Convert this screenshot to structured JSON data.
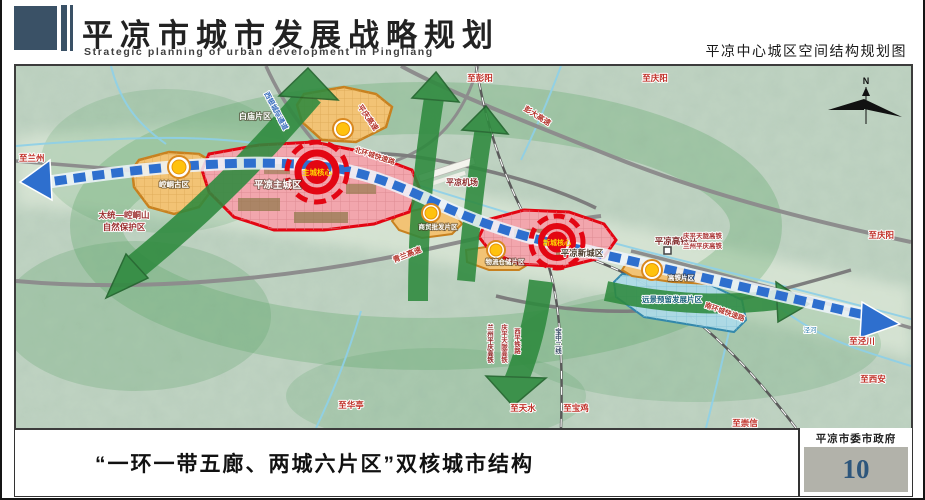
{
  "header": {
    "title": "平凉市城市发展战略规划",
    "subtitle": "Strategic planning of urban development in Pingliang",
    "map_caption": "平凉中心城区空间结构规划图"
  },
  "footer": {
    "caption": "“一环一带五廊、两城六片区”双核城市结构",
    "agency": "平凉市委市政府",
    "page_number": "10"
  },
  "map": {
    "compass": "N",
    "cores": {
      "main": "主城核心",
      "secondary": "新城核心"
    },
    "zones": {
      "main_city": "平凉主城区",
      "new_city": "平凉新城区",
      "kongtong": "崆峒古区",
      "baimiao": "白庙片区",
      "shangmao": "商贸批发片区",
      "wuliu": "物流仓储片区",
      "gaotie": "高铁片区",
      "yuanjing": "远景预留发展片区"
    },
    "stations": {
      "hsr": "平凉高铁站",
      "airport": "平凉机场"
    },
    "roads": {
      "pengda": "彭大高速",
      "qinglan": "青兰高速",
      "pingqing": "平庆高速",
      "north_ring": "北环城快速路",
      "south_ring": "南环城快速路",
      "intercity": "西银城际通道"
    },
    "rails": {
      "near_station": [
        "庆平天陇高铁",
        "兰州平庆高铁"
      ],
      "south": [
        "兰州平庆高铁",
        "庆平天陇高铁",
        "西平铁路",
        "宝中二线"
      ]
    },
    "destinations": {
      "lanzhou": "至兰州",
      "pengyang": "至彭阳",
      "qingyang_top": "至庆阳",
      "qingyang_right": "至庆阳",
      "jingchuan": "至泾川",
      "xian": "至西安",
      "chongxin": "至崇信",
      "huating": "至华亭",
      "tianshui": "至天水",
      "baoji": "至宝鸡"
    },
    "nature": {
      "reserve_line1": "太统—崆峒山",
      "reserve_line2": "自然保护区",
      "river": "泾河"
    }
  },
  "colors": {
    "header_blue": "#3a5166",
    "page_number_blue": "#2d567c",
    "zone_red": "#e30613",
    "zone_pink": "#f2a6ad",
    "zone_orange": "#f2c375",
    "zone_cyan": "#aedbe8",
    "corridor_green": "#2e8a3e",
    "belt_blue": "#2f6fd0",
    "footer_gray": "#b2b2aa"
  }
}
